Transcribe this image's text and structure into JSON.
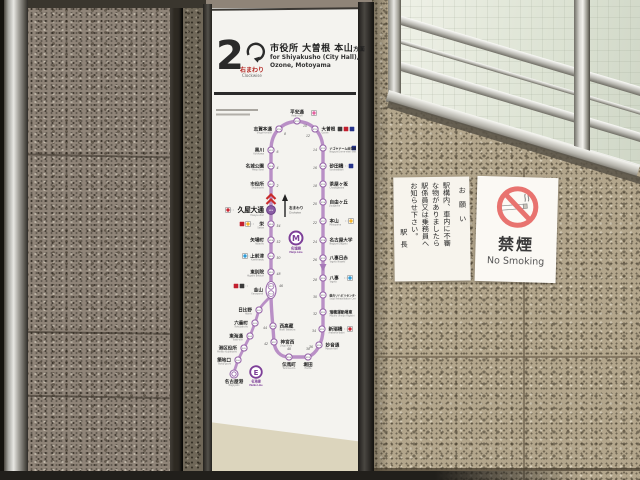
{
  "palette": {
    "wall_dark": "#8f8478",
    "wall_light": "#b3a68c",
    "meijo_line_purple": "#b98fc6",
    "logo_purple": "#7d3f98",
    "no_smoking_red": "#e8736f",
    "direction_red": "#c92c2c"
  },
  "sign_header": {
    "platform_number": "2",
    "loop_label_jp": "右まわり",
    "loop_label_en": "Clockwise",
    "dest_jp": "市役所 大曽根 本山",
    "dest_suffix": "方面",
    "dest_en_1": "for Shiyakusho (City Hall),",
    "dest_en_2": "Ozone, Motoyama"
  },
  "sign": {
    "map": {
      "map_labels": {
        "meijo_letter": "M",
        "meijo_jp": "名城線",
        "meijo_en": "Meijo Line",
        "meiko_letter": "E",
        "meiko_jp": "名港線",
        "meiko_en": "Meiko Line",
        "clockwise_jp": "右まわり",
        "clockwise_en": "Clockwise"
      },
      "current_station": "久屋大通",
      "lines": {
        "sakuradori": {
          "color": "#c9252f",
          "type": "subway"
        },
        "higashiyama": {
          "color": "#f5b52b",
          "type": "subway"
        },
        "tsurumai": {
          "color": "#2e9bd6",
          "type": "subway"
        },
        "kamiiida": {
          "color": "#e4609f",
          "type": "subway"
        },
        "jr": {
          "color": "#3a3a3a",
          "type": "rail"
        },
        "meitetsu": {
          "color": "#c21f2e",
          "type": "rail"
        },
        "yutorito": {
          "color": "#27348b",
          "type": "rail"
        }
      },
      "stations": [
        {
          "name": "黒川",
          "romaji": "Kurokawa",
          "code": "M09",
          "x": 59,
          "y": 50,
          "side": "left",
          "min": {
            "v": "6",
            "x": 64.5,
            "y": 53,
            "a": "start"
          }
        },
        {
          "name": "名城公園",
          "romaji": "Meijo Koen",
          "code": "M08",
          "x": 59,
          "y": 66,
          "side": "left",
          "min": {
            "v": "4",
            "x": 64.5,
            "y": 69,
            "a": "start"
          }
        },
        {
          "name": "市役所",
          "romaji": "Shiyakusho",
          "code": "M07",
          "x": 59,
          "y": 84,
          "side": "left",
          "min": {
            "v": "2",
            "x": 64.5,
            "y": 87,
            "a": "start"
          }
        },
        {
          "name": "久屋大通",
          "romaji": "Hisaya-odori",
          "code": "M06",
          "x": 59,
          "y": 110,
          "side": "left",
          "current": true,
          "transfers": [
            "sakuradori"
          ],
          "tx": 16
        },
        {
          "name": "栄",
          "romaji": "Sakae",
          "code": "M05",
          "x": 59,
          "y": 124,
          "side": "left",
          "transfers": [
            "higashiyama",
            "meitetsu"
          ],
          "tx": 36,
          "min": {
            "v": "54",
            "x": 64.5,
            "y": 127,
            "a": "start"
          }
        },
        {
          "name": "矢場町",
          "romaji": "Yabacho",
          "code": "M04",
          "x": 59,
          "y": 140,
          "side": "left",
          "min": {
            "v": "52",
            "x": 64.5,
            "y": 143,
            "a": "start"
          }
        },
        {
          "name": "上前津",
          "romaji": "Kamimaezu",
          "code": "M03",
          "x": 59,
          "y": 156,
          "side": "left",
          "transfers": [
            "tsurumai"
          ],
          "tx": 33,
          "min": {
            "v": "50",
            "x": 64.5,
            "y": 159,
            "a": "start"
          }
        },
        {
          "name": "東別院",
          "romaji": "Higashi Betsuin",
          "code": "M02",
          "x": 59,
          "y": 172,
          "side": "left",
          "min": {
            "v": "48",
            "x": 64.5,
            "y": 175,
            "a": "start"
          }
        },
        {
          "name": "金山",
          "romaji": "Kanayama",
          "code": "M01",
          "code2": "E01",
          "type": "junction",
          "x": 59,
          "y": 190,
          "side": "left",
          "transfers": [
            "jr",
            "meitetsu"
          ],
          "tx": 30,
          "ty": 186,
          "min": {
            "v": "46",
            "x": 67,
            "y": 187,
            "a": "start"
          }
        },
        {
          "name": "日比野",
          "romaji": "Hibino",
          "code": "E02",
          "x": 47,
          "y": 210,
          "side": "left"
        },
        {
          "name": "六番町",
          "romaji": "Rokubancho",
          "code": "E03",
          "x": 43,
          "y": 223,
          "side": "left"
        },
        {
          "name": "東海通",
          "romaji": "Tokai-dori",
          "code": "E04",
          "x": 38,
          "y": 236,
          "side": "left"
        },
        {
          "name": "港区役所",
          "romaji": "Minato Kuyakusho",
          "code": "E05",
          "x": 32,
          "y": 248,
          "side": "left"
        },
        {
          "name": "築地口",
          "romaji": "Tsukiji-guchi",
          "code": "E06",
          "x": 26,
          "y": 260,
          "side": "left"
        },
        {
          "name": "名古屋港",
          "romaji": "Nagoyako",
          "code": "E07",
          "type": "terminal",
          "x": 22,
          "y": 274,
          "side": "bottom"
        },
        {
          "name": "西高蔵",
          "romaji": "Nishi Takakura",
          "code": "M28",
          "x": 61,
          "y": 226,
          "side": "right",
          "min": {
            "v": "44",
            "x": 55,
            "y": 229,
            "a": "end"
          }
        },
        {
          "name": "神宮西",
          "romaji": "Jingu Nishi",
          "code": "M27",
          "x": 62,
          "y": 242,
          "side": "right",
          "min": {
            "v": "42",
            "x": 56,
            "y": 245,
            "a": "end"
          }
        },
        {
          "name": "伝馬町",
          "romaji": "Temma-cho",
          "code": "M26",
          "x": 77,
          "y": 257,
          "side": "bottom",
          "min": {
            "v": "40",
            "x": 77,
            "y": 250,
            "a": "middle"
          }
        },
        {
          "name": "堀田",
          "romaji": "Horita",
          "code": "M25",
          "x": 96,
          "y": 257,
          "side": "bottom",
          "min": {
            "v": "38",
            "x": 96,
            "y": 250,
            "a": "middle"
          }
        },
        {
          "name": "妙音通",
          "romaji": "Myoon-dori",
          "code": "M24",
          "x": 107,
          "y": 245,
          "side": "right",
          "min": {
            "v": "36",
            "x": 101,
            "y": 248,
            "a": "end"
          }
        },
        {
          "name": "新瑞橋",
          "romaji": "Aratama-bashi",
          "code": "M23",
          "x": 110,
          "y": 229,
          "side": "right",
          "transfers": [
            "sakuradori"
          ],
          "tx": 138,
          "min": {
            "v": "34",
            "x": 104,
            "y": 232,
            "a": "end"
          }
        },
        {
          "name": "瑞穂運動場東",
          "romaji": "Mizuho Undojo Higashi",
          "code": "M22",
          "fs": 3.8,
          "x": 111,
          "y": 212,
          "side": "right",
          "min": {
            "v": "32",
            "x": 105,
            "y": 215,
            "a": "end"
          }
        },
        {
          "name": "総合リハビリセンター",
          "romaji": "Sogo Rehabilitation Center",
          "code": "M21",
          "fs": 2.8,
          "x": 111,
          "y": 195,
          "side": "right",
          "min": {
            "v": "30",
            "x": 105,
            "y": 198,
            "a": "end"
          }
        },
        {
          "name": "八事",
          "romaji": "Yagoto",
          "code": "M20",
          "x": 111,
          "y": 178,
          "side": "right",
          "transfers": [
            "tsurumai"
          ],
          "tx": 138,
          "min": {
            "v": "28",
            "x": 105,
            "y": 181,
            "a": "end"
          }
        },
        {
          "name": "八事日赤",
          "romaji": "Yagoto Nisseki",
          "code": "M19",
          "x": 111,
          "y": 158,
          "side": "right",
          "min": {
            "v": "26",
            "x": 105,
            "y": 161,
            "a": "end"
          }
        },
        {
          "name": "名古屋大学",
          "romaji": "Nagoya Daigaku",
          "code": "M18",
          "x": 111,
          "y": 140,
          "side": "right",
          "min": {
            "v": "24",
            "x": 105,
            "y": 143,
            "a": "end"
          }
        },
        {
          "name": "本山",
          "romaji": "Motoyama",
          "code": "M17",
          "x": 111,
          "y": 121,
          "side": "right",
          "transfers": [
            "higashiyama"
          ],
          "tx": 139,
          "min": {
            "v": "22",
            "x": 105,
            "y": 124,
            "a": "end"
          }
        },
        {
          "name": "自由ヶ丘",
          "romaji": "Jiyugaoka",
          "code": "M16",
          "x": 111,
          "y": 102,
          "side": "right",
          "min": {
            "v": "20",
            "x": 105,
            "y": 105,
            "a": "end"
          }
        },
        {
          "name": "茶屋ヶ坂",
          "romaji": "Chayagasaka",
          "code": "M15",
          "x": 111,
          "y": 84,
          "side": "right",
          "min": {
            "v": "18",
            "x": 105,
            "y": 87,
            "a": "end"
          }
        },
        {
          "name": "砂田橋",
          "romaji": "Sunadabashi",
          "code": "M14",
          "x": 111,
          "y": 66,
          "side": "right",
          "transfers": [
            "yutorito"
          ],
          "tx": 139,
          "min": {
            "v": "16",
            "x": 105,
            "y": 69,
            "a": "end"
          }
        },
        {
          "name": "ナゴヤドーム前矢田",
          "romaji": "Nagoya Dome-mae Yada",
          "code": "M13",
          "fs": 3,
          "x": 111,
          "y": 48,
          "side": "right",
          "transfers": [
            "yutorito"
          ],
          "tx": 142,
          "nodash": true,
          "min": {
            "v": "14",
            "x": 105,
            "y": 51,
            "a": "end"
          }
        },
        {
          "name": "大曽根",
          "romaji": "Ozone",
          "code": "M12",
          "x": 103,
          "y": 29,
          "side": "right",
          "transfers": [
            "jr",
            "meitetsu",
            "yutorito"
          ],
          "tx": 128,
          "nodash": true,
          "min": {
            "v": "12",
            "x": 98,
            "y": 37,
            "a": "end"
          }
        },
        {
          "name": "平安通",
          "romaji": "Heian-dori",
          "code": "M11",
          "x": 85,
          "y": 21,
          "side": "top",
          "transfers": [
            "kamiiida"
          ],
          "tx": 102,
          "ty": 13,
          "min": {
            "v": "10",
            "x": 91,
            "y": 27,
            "a": "start"
          }
        },
        {
          "name": "志賀本通",
          "romaji": "Shiga-hondori",
          "code": "M10",
          "x": 67,
          "y": 29,
          "side": "left",
          "min": {
            "v": "8",
            "x": 72,
            "y": 35,
            "a": "start"
          }
        }
      ]
    }
  },
  "notice": {
    "title_col": "お願い",
    "cols": [
      "駅構内、車内に不審",
      "な物がありましたら",
      "駅係員又は乗務員へ",
      "お知らせ下さい。"
    ],
    "signoff": "駅長"
  },
  "no_smoking": {
    "label_jp": "禁煙",
    "label_en": "No Smoking"
  }
}
